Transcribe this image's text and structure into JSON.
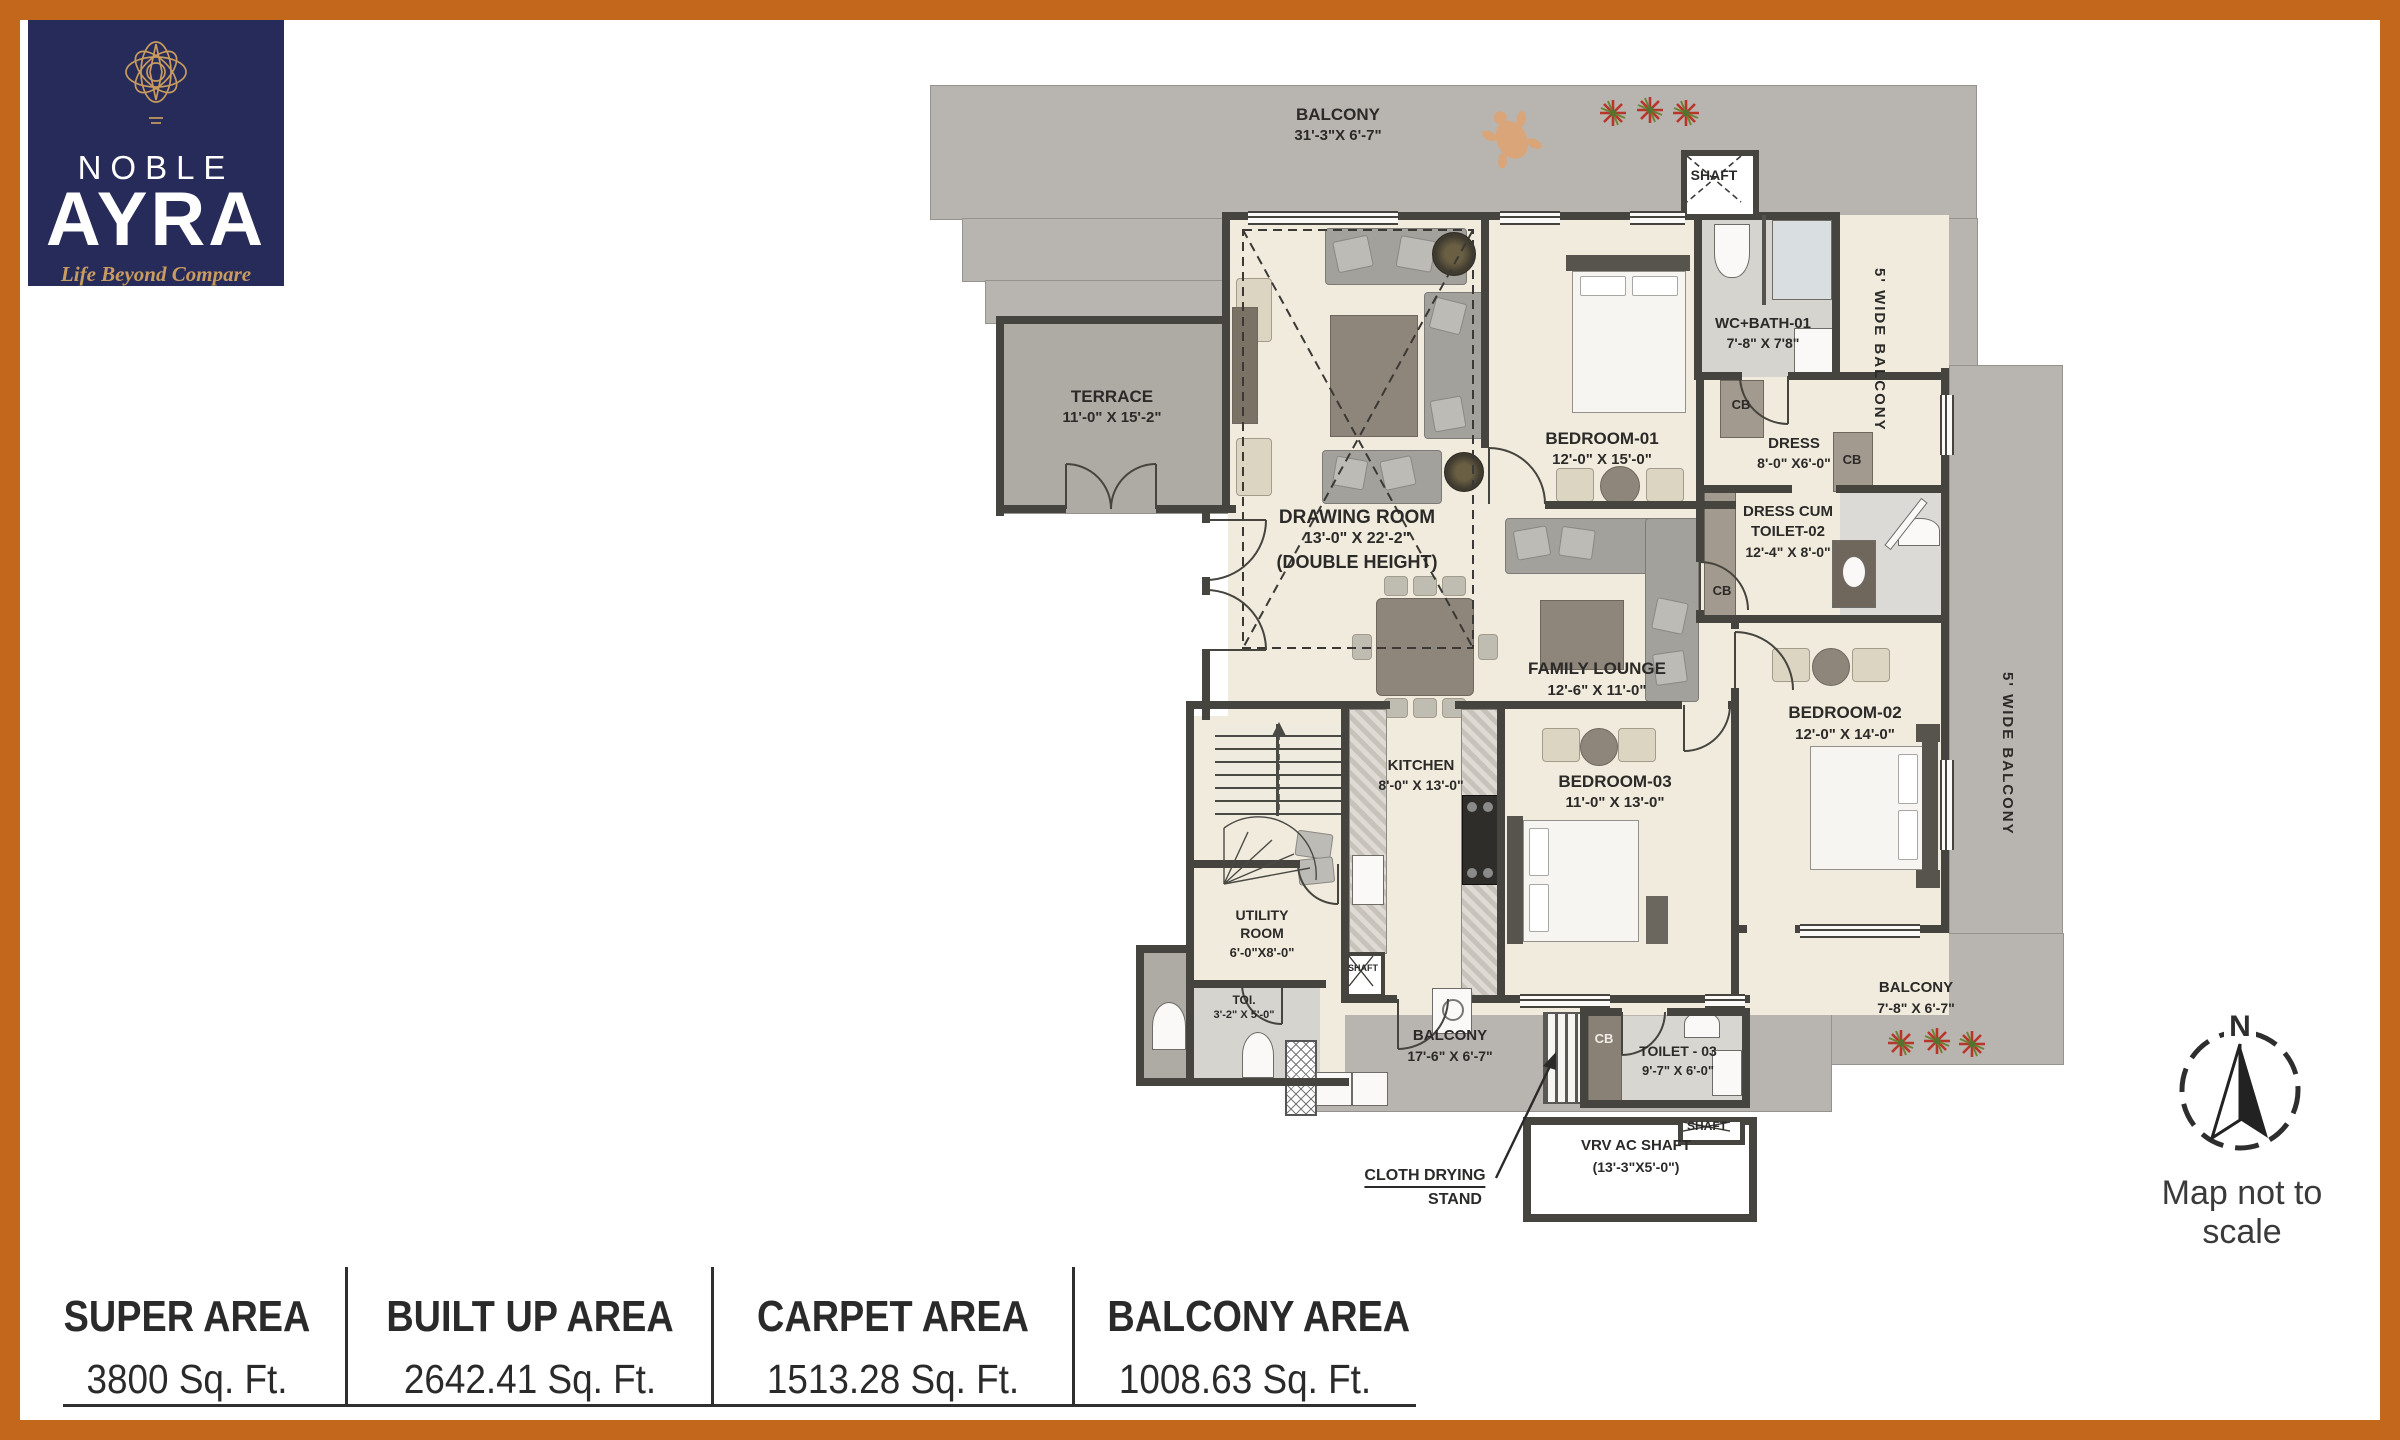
{
  "brand": {
    "line1": "NOBLE",
    "line2": "AYRA",
    "tagline": "Life Beyond Compare"
  },
  "compass": {
    "cardinal": "N",
    "caption": "Map not to scale"
  },
  "labels": {
    "cb": "CB"
  },
  "areas": [
    {
      "label": "SUPER AREA",
      "value": "3800 Sq. Ft."
    },
    {
      "label": "BUILT UP AREA",
      "value": "2642.41 Sq. Ft."
    },
    {
      "label": "CARPET AREA",
      "value": "1513.28 Sq. Ft."
    },
    {
      "label": "BALCONY AREA",
      "value": "1008.63 Sq. Ft."
    }
  ],
  "rooms": {
    "balconyTop": {
      "name": "BALCONY",
      "dims": "31'-3\"X 6'-7\""
    },
    "shaftTop": {
      "name": "SHAFT"
    },
    "wideBalconyTop": {
      "name": "5' WIDE BALCONY"
    },
    "wideBalconyMid": {
      "name": "5' WIDE BALCONY"
    },
    "terrace": {
      "name": "TERRACE",
      "dims": "11'-0\" X 15'-2\""
    },
    "drawingRoom": {
      "name": "DRAWING ROOM",
      "dims": "13'-0\" X 22'-2\"",
      "note": "(DOUBLE HEIGHT)"
    },
    "bedroom1": {
      "name": "BEDROOM-01",
      "dims": "12'-0\" X 15'-0\""
    },
    "wcBath1": {
      "name": "WC+BATH-01",
      "dims": "7'-8\" X 7'8\""
    },
    "dress": {
      "name": "DRESS",
      "dims": "8'-0\" X6'-0\""
    },
    "dressToilet2": {
      "line1": "DRESS CUM",
      "line2": "TOILET-02",
      "dims": "12'-4\" X 8'-0\""
    },
    "familyLounge": {
      "name": "FAMILY LOUNGE",
      "dims": "12'-6\" X 11'-0\""
    },
    "bedroom2": {
      "name": "BEDROOM-02",
      "dims": "12'-0\" X 14'-0\""
    },
    "kitchen": {
      "name": "KITCHEN",
      "dims": "8'-0\" X 13'-0\""
    },
    "bedroom3": {
      "name": "BEDROOM-03",
      "dims": "11'-0\" X 13'-0\""
    },
    "utility": {
      "line1": "UTILITY",
      "line2": "ROOM",
      "dims": "6'-0\"X8'-0\""
    },
    "toi": {
      "name": "TOI.",
      "dims": "3'-2\" X 5'-0\""
    },
    "balconyRear": {
      "name": "BALCONY",
      "dims": "17'-6\" X 6'-7\""
    },
    "toilet3": {
      "name": "TOILET - 03",
      "dims": "9'-7\" X 6'-0\""
    },
    "shaftKitchen": {
      "name": "SHAFT"
    },
    "shaftBottom": {
      "name": "SHAFT"
    },
    "vrv": {
      "line1": "VRV AC SHAFT",
      "line2": "(13'-3\"X5'-0\")"
    },
    "balconyBottomRight": {
      "name": "BALCONY",
      "dims": "7'-8\" X 6'-7\""
    },
    "clothDrying": {
      "line1": "CLOTH DRYING",
      "line2": "STAND"
    }
  }
}
